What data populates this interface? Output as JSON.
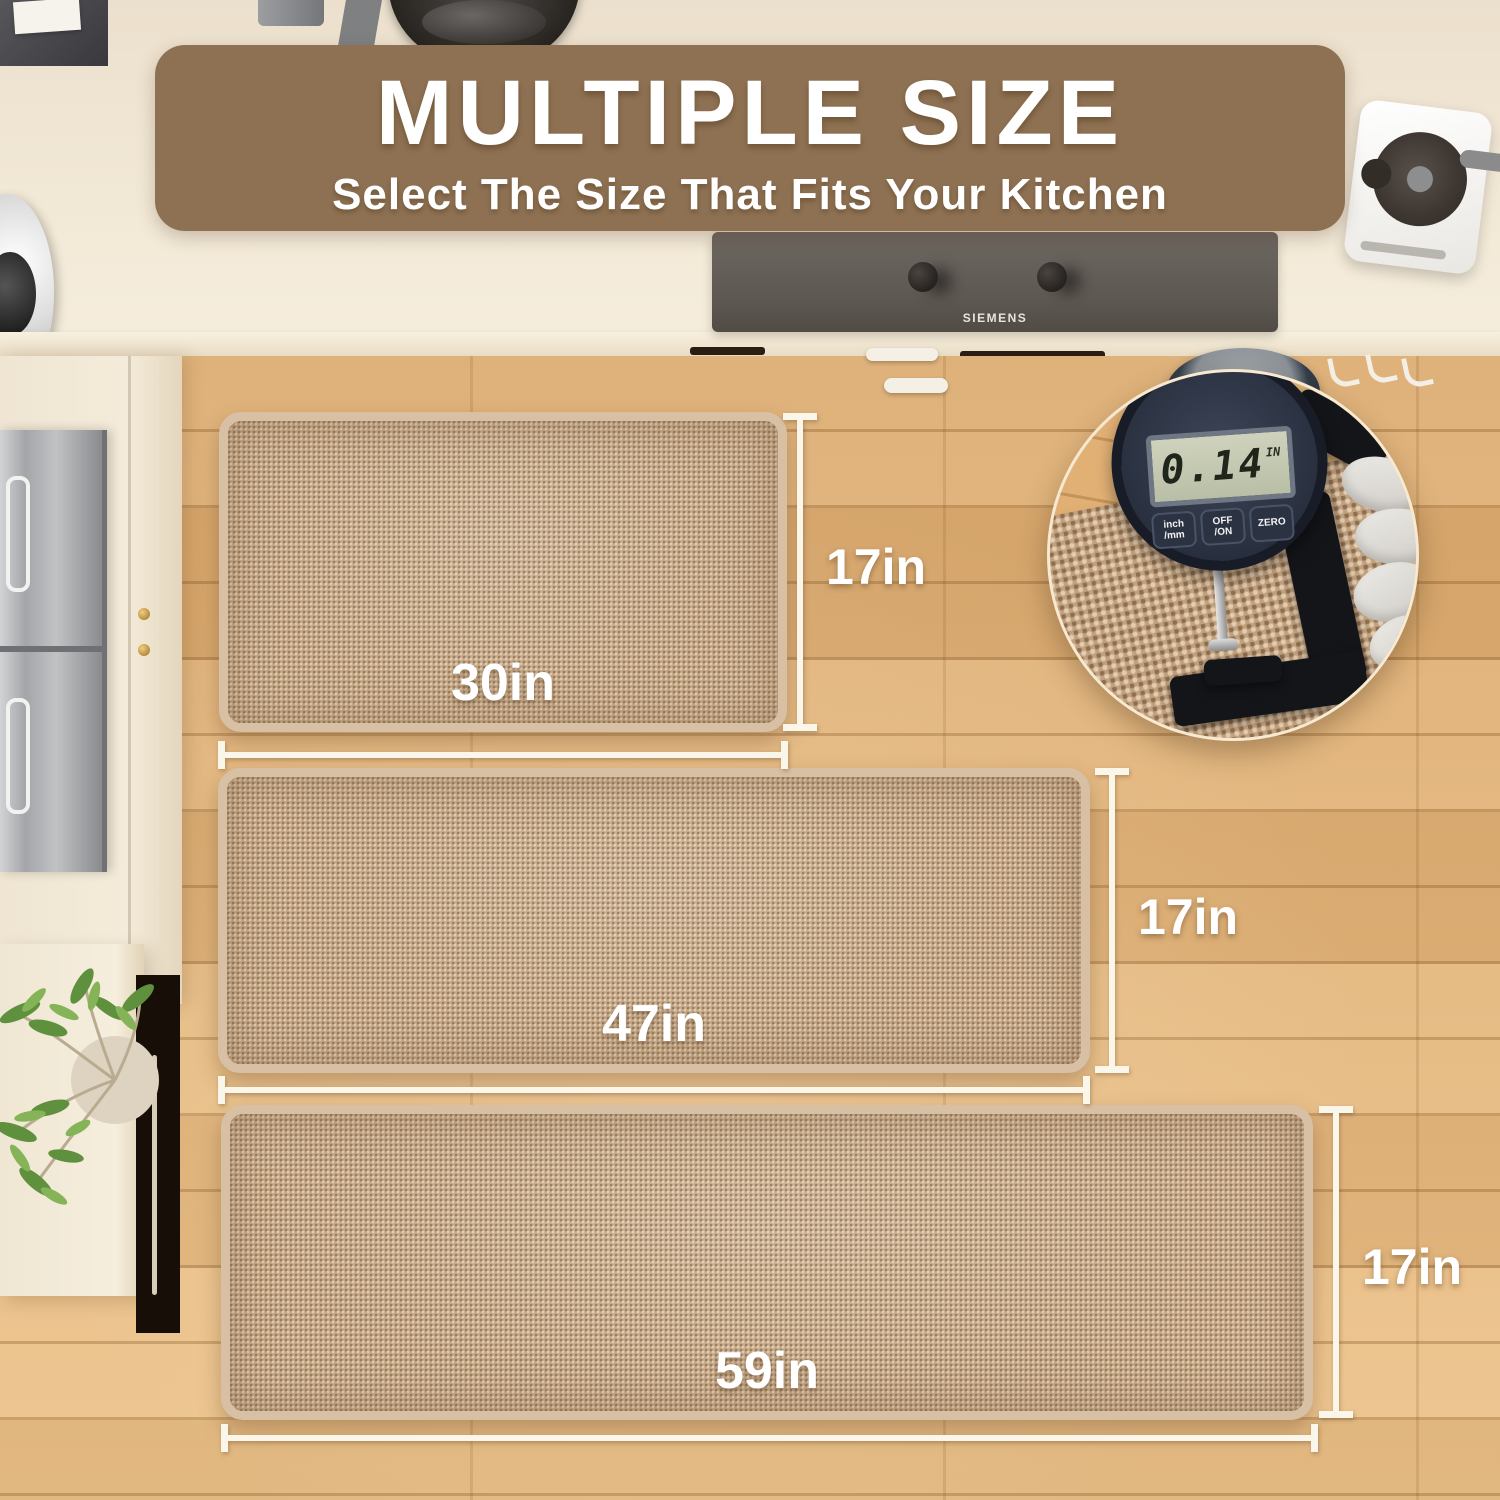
{
  "banner": {
    "title": "MULTIPLE SIZE",
    "subtitle": "Select The Size That Fits Your Kitchen"
  },
  "stove": {
    "brand": "SIEMENS"
  },
  "mats": [
    {
      "name": "small",
      "width_label": "30in",
      "height_label": "17in"
    },
    {
      "name": "medium",
      "width_label": "47in",
      "height_label": "17in"
    },
    {
      "name": "large",
      "width_label": "59in",
      "height_label": "17in"
    }
  ],
  "thickness_gauge": {
    "reading": "0.14",
    "unit": "IN",
    "buttons": [
      {
        "line1": "inch",
        "line2": "/mm"
      },
      {
        "line1": "OFF",
        "line2": "/ON"
      },
      {
        "line1": "ZERO",
        "line2": ""
      }
    ]
  },
  "colors": {
    "banner_bg": "#8e7152",
    "mat_base": "#c3a584",
    "mat_border": "#d8c0a5",
    "floor_base": "#e0b077",
    "dim_line": "#fbf6ea",
    "lcd_bg": "#c2c6b2",
    "gauge_body": "#2c3343"
  }
}
